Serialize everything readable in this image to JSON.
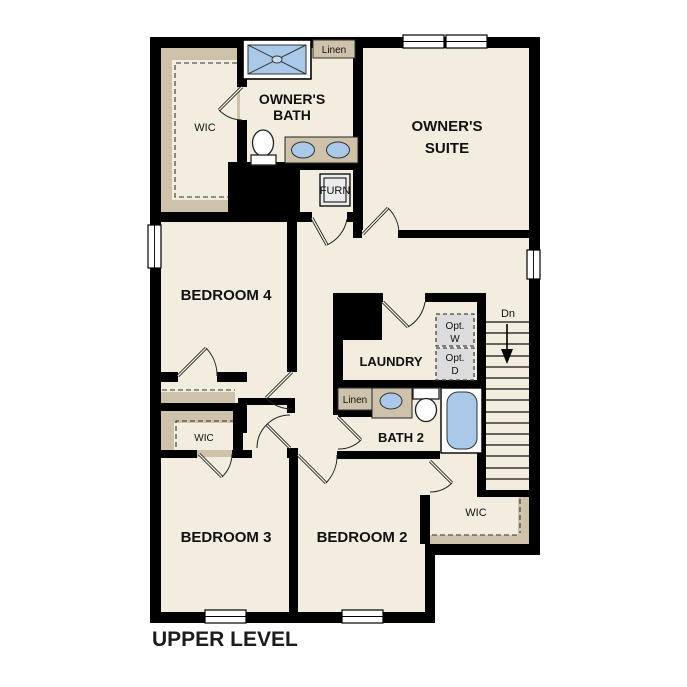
{
  "title": "UPPER LEVEL",
  "rooms": {
    "owners_suite": {
      "line1": "OWNER'S",
      "line2": "SUITE"
    },
    "owners_bath": {
      "line1": "OWNER'S",
      "line2": "BATH"
    },
    "bedroom4": "BEDROOM 4",
    "bedroom3": "BEDROOM 3",
    "bedroom2": "BEDROOM 2",
    "laundry": "LAUNDRY",
    "bath2": "BATH 2",
    "wic_owner": "WIC",
    "wic_bedroom3": "WIC",
    "wic_bedroom2": "WIC",
    "linen_upper": "Linen",
    "linen_bath2": "Linen",
    "furnace": "FURN"
  },
  "appliances": {
    "opt_washer": {
      "line1": "Opt.",
      "line2": "W"
    },
    "opt_dryer": {
      "line1": "Opt.",
      "line2": "D"
    }
  },
  "stairs": {
    "direction_label": "Dn"
  },
  "colors": {
    "floor": "#f3ede0",
    "wall": "#000000",
    "closet_tan": "#cec2aa",
    "fixture_blue": "#aac8e8",
    "optional_gray": "#dcdcdc",
    "label_text": "#111111"
  }
}
